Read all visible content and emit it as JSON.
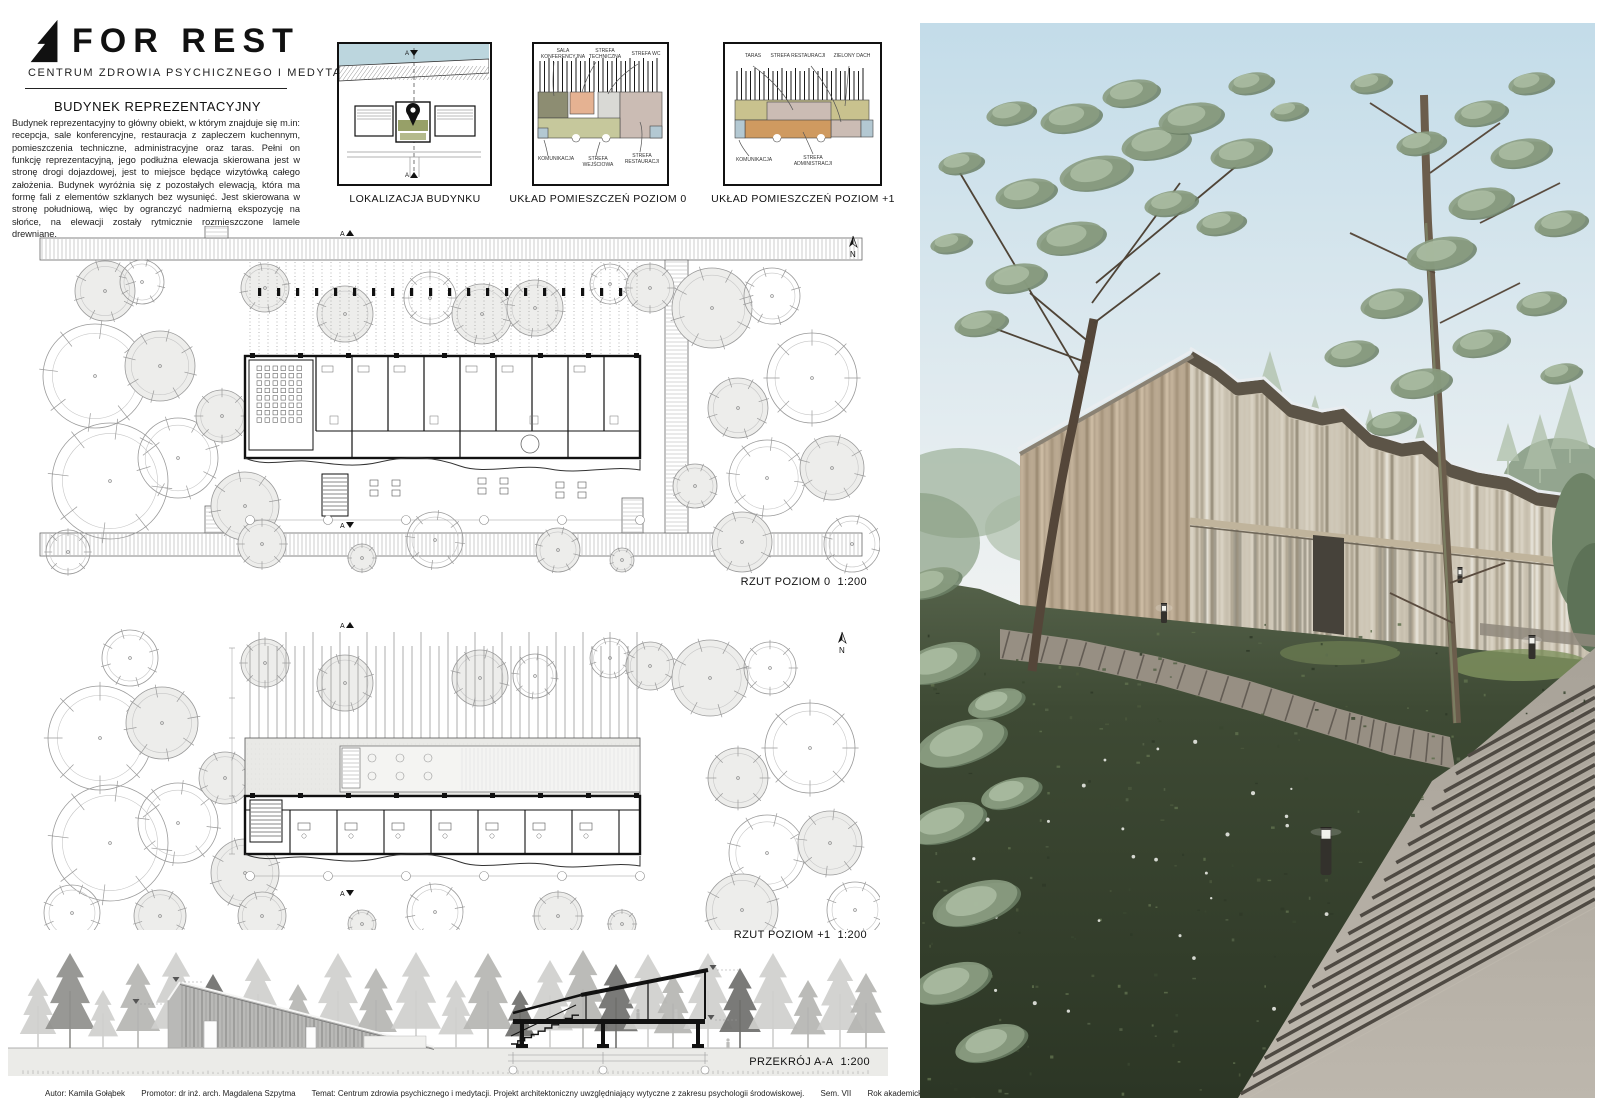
{
  "header": {
    "logo": "FOR REST",
    "subtitle": "CENTRUM ZDROWIA PSYCHICZNEGO I MEDYTACJI"
  },
  "intro": {
    "title": "BUDYNEK REPREZENTACYJNY",
    "body": "Budynek reprezentacyjny to główny obiekt, w którym znajduje się m.in: recepcja, sale konferencyjne, restauracja z zapleczem kuchennym, pomieszczenia techniczne, administracyjne oraz taras. Pełni on funkcję reprezentacyjną, jego podłużna elewacja skierowana jest w stronę drogi dojazdowej, jest to miejsce będące wizytówką całego założenia. Budynek wyróżnia się z pozostałych elewacją, która ma formę fali z elementów szklanych bez wysunięć. Jest skierowana w stronę południową, więc by ogranczyć nadmierną ekspozycję na słońce, na elewacji zostały rytmicznie rozmieszczone lamele drewniane."
  },
  "diagrams": [
    {
      "label": "LOKALIZACJA BUDYNKU",
      "annotations": []
    },
    {
      "label": "UKŁAD POMIESZCZEŃ POZIOM 0",
      "annotations": [
        "SALA KONFERENCYJNA",
        "STREFA TECHNICZNA",
        "STREFA WC",
        "KOMUNIKACJA",
        "STREFA WEJŚCIOWA",
        "STREFA RESTAURACJI"
      ]
    },
    {
      "label": "UKŁAD POMIESZCZEŃ POZIOM +1",
      "annotations": [
        "TARAS",
        "STREFA RESTAURACJI",
        "ZIELONY DACH",
        "KOMUNIKACJA",
        "STREFA ADMINISTRACJI"
      ]
    }
  ],
  "plans": [
    {
      "label": "RZUT POZIOM 0",
      "scale": "1:200"
    },
    {
      "label": "RZUT POZIOM +1",
      "scale": "1:200"
    }
  ],
  "section": {
    "label": "PRZEKRÓJ A-A",
    "scale": "1:200"
  },
  "markers": {
    "section_letter": "A",
    "north_letter": "N"
  },
  "footer": {
    "author": "Autor: Kamila Gołąbek",
    "promoter": "Promotor: dr inż. arch. Magdalena Szpytma",
    "subject": "Temat: Centrum zdrowia psychicznego i medytacji. Projekt architektoniczny uwzględniający wytyczne z zakresu psychologii środowiskowej.",
    "semester": "Sem. VII",
    "year": "Rok akademicki 2020/21",
    "university": "Politechnika Rzeszowska",
    "board": "Plansza 3"
  },
  "colors": {
    "zone_conference": "#8d8d72",
    "zone_technical": "#e5b292",
    "zone_wc": "#d9d9d5",
    "zone_restaurant": "#cbbcb4",
    "zone_entrance": "#c6c89c",
    "zone_circulation": "#b3c8d2",
    "zone_green_roof": "#c9c28e",
    "zone_admin": "#cf9a60",
    "water": "#bcd6de",
    "site_building_green": "#97a068"
  }
}
